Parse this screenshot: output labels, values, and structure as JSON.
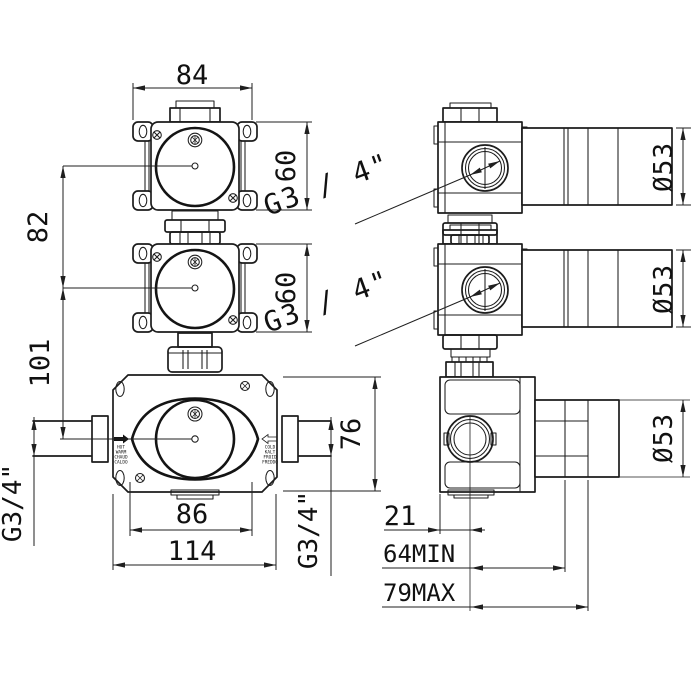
{
  "drawing": {
    "colors": {
      "background": "#ffffff",
      "line": "#1c1c1c",
      "dim": "#1a1a1a"
    },
    "dims": {
      "top_valve_width": "84",
      "top_valve_height": "60",
      "middle_valve_height": "60",
      "spacing_top_to_middle": "82",
      "spacing_middle_to_bottom": "101",
      "mixer_height": "76",
      "mixer_plate_width": "86",
      "mixer_body_width": "114",
      "port_offset": "21",
      "recess_depth_min": "64MIN",
      "recess_depth_max": "79MAX",
      "thread_front_left": "G3/4\"",
      "thread_front_right": "G3/4\"",
      "thread_side_top": "G3 / 4\"",
      "thread_side_middle": "G3 / 4\"",
      "cylinder_dia_top": "Ø53",
      "cylinder_dia_middle": "Ø53",
      "cylinder_dia_bottom": "Ø53"
    },
    "port_labels": {
      "hot": [
        "HOT",
        "WARM",
        "CHAUD",
        "CALDO"
      ],
      "cold": [
        "COLD",
        "KALT",
        "FROID",
        "FREDDO"
      ]
    }
  }
}
